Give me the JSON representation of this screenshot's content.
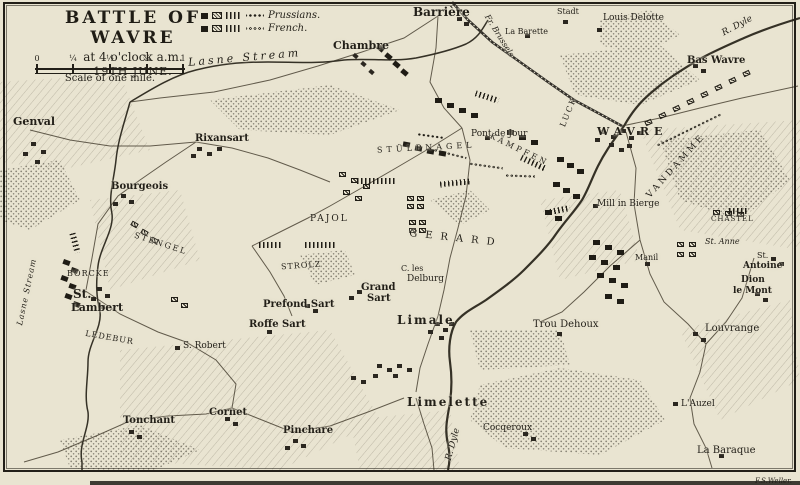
{
  "title_block": {
    "title": "BATTLE OF WAVRE",
    "subtitle": "at 4 o'clock a.m.",
    "date": "19TH JUNE.",
    "scale_caption": "Scale of one mile.",
    "scale_ticks": [
      "0",
      "¼",
      "½",
      "¾",
      "1"
    ]
  },
  "legend": {
    "prussians_label": "Prussians.",
    "french_label": "French."
  },
  "signature": "F.S.Weller.",
  "colors": {
    "paper": "#e9e4d1",
    "ink": "#221f18",
    "unit_black": "#1f1c15"
  },
  "labels": [
    {
      "t": "Lasne Stream",
      "x": 183,
      "y": 48,
      "fs": 11,
      "i": 1,
      "ls": 3,
      "r": -5
    },
    {
      "t": "Barrière",
      "x": 408,
      "y": 2,
      "fs": 12,
      "b": 1
    },
    {
      "t": "Chambre",
      "x": 328,
      "y": 36,
      "fs": 11,
      "b": 1
    },
    {
      "t": "La Barette",
      "x": 500,
      "y": 24,
      "fs": 8
    },
    {
      "t": "Stadt",
      "x": 552,
      "y": 4,
      "fs": 8
    },
    {
      "t": "Louis Delotte",
      "x": 598,
      "y": 10,
      "fs": 9
    },
    {
      "t": "R. Dyle",
      "x": 716,
      "y": 18,
      "fs": 9,
      "i": 1,
      "r": -28
    },
    {
      "t": "Bas Wavre",
      "x": 682,
      "y": 52,
      "fs": 10,
      "b": 1
    },
    {
      "t": "Fr. Brussels",
      "x": 470,
      "y": 28,
      "fs": 8,
      "i": 1,
      "r": 58
    },
    {
      "t": "Genval",
      "x": 8,
      "y": 112,
      "fs": 11,
      "b": 1
    },
    {
      "t": "Rixansart",
      "x": 190,
      "y": 130,
      "fs": 10,
      "b": 1
    },
    {
      "t": "Bourgeois",
      "x": 106,
      "y": 178,
      "fs": 10,
      "b": 1
    },
    {
      "t": "Pont de Jour",
      "x": 466,
      "y": 126,
      "fs": 9
    },
    {
      "t": "WAVRE",
      "x": 592,
      "y": 122,
      "fs": 11,
      "ls": 5,
      "b": 1
    },
    {
      "t": "LUCK",
      "x": 548,
      "y": 104,
      "fs": 8,
      "ls": 2,
      "r": -68
    },
    {
      "t": "STÜLPNAGEL",
      "x": 372,
      "y": 140,
      "fs": 8,
      "ls": 4,
      "r": -3
    },
    {
      "t": "KÄMPFEN",
      "x": 482,
      "y": 142,
      "fs": 8,
      "ls": 3,
      "r": 26
    },
    {
      "t": "VANDAMME",
      "x": 630,
      "y": 158,
      "fs": 9,
      "ls": 3,
      "r": -48
    },
    {
      "t": "Mill in Bierge",
      "x": 592,
      "y": 196,
      "fs": 9
    },
    {
      "t": "PAJOL",
      "x": 305,
      "y": 211,
      "fs": 9,
      "ls": 2
    },
    {
      "t": "GERARD",
      "x": 404,
      "y": 230,
      "fs": 10,
      "ls": 8,
      "r": 6
    },
    {
      "t": "STENGEL",
      "x": 128,
      "y": 236,
      "fs": 8,
      "ls": 2,
      "r": 18
    },
    {
      "t": "BORCKE",
      "x": 62,
      "y": 266,
      "fs": 8,
      "ls": 1
    },
    {
      "t": "St.",
      "x": 68,
      "y": 284,
      "fs": 12,
      "b": 1
    },
    {
      "t": "Lambert",
      "x": 66,
      "y": 298,
      "fs": 11,
      "b": 1
    },
    {
      "t": "LEDEBUR",
      "x": 80,
      "y": 330,
      "fs": 8,
      "ls": 1,
      "r": 10
    },
    {
      "t": "Lasne Stream",
      "x": -12,
      "y": 284,
      "fs": 8,
      "i": 1,
      "r": -78,
      "ls": 1
    },
    {
      "t": "STROLZ",
      "x": 276,
      "y": 258,
      "fs": 8,
      "ls": 1,
      "r": -4
    },
    {
      "t": "Prefond Sart",
      "x": 258,
      "y": 296,
      "fs": 10,
      "b": 1
    },
    {
      "t": "Grand",
      "x": 356,
      "y": 279,
      "fs": 10,
      "b": 1
    },
    {
      "t": "Sart",
      "x": 362,
      "y": 290,
      "fs": 10,
      "b": 1
    },
    {
      "t": "Roffe Sart",
      "x": 244,
      "y": 316,
      "fs": 10,
      "b": 1
    },
    {
      "t": "C. les",
      "x": 396,
      "y": 261,
      "fs": 8
    },
    {
      "t": "Delburg",
      "x": 402,
      "y": 271,
      "fs": 9
    },
    {
      "t": "Limale",
      "x": 392,
      "y": 310,
      "fs": 12,
      "b": 1,
      "ls": 2
    },
    {
      "t": "S. Robert",
      "x": 178,
      "y": 338,
      "fs": 9
    },
    {
      "t": "Trou Dehoux",
      "x": 528,
      "y": 316,
      "fs": 10
    },
    {
      "t": "Manil",
      "x": 630,
      "y": 250,
      "fs": 8
    },
    {
      "t": "Louvrange",
      "x": 700,
      "y": 320,
      "fs": 10
    },
    {
      "t": "Dion",
      "x": 736,
      "y": 272,
      "fs": 9,
      "b": 1
    },
    {
      "t": "le Mont",
      "x": 728,
      "y": 283,
      "fs": 9,
      "b": 1
    },
    {
      "t": "St.",
      "x": 752,
      "y": 248,
      "fs": 8
    },
    {
      "t": "Antoine",
      "x": 738,
      "y": 258,
      "fs": 9,
      "b": 1
    },
    {
      "t": "St. Anne",
      "x": 700,
      "y": 234,
      "fs": 8,
      "i": 1
    },
    {
      "t": "CHASTEL",
      "x": 706,
      "y": 212,
      "fs": 7,
      "ls": 1
    },
    {
      "t": "Tonchant",
      "x": 118,
      "y": 412,
      "fs": 10,
      "b": 1
    },
    {
      "t": "Cornet",
      "x": 204,
      "y": 404,
      "fs": 10,
      "b": 1
    },
    {
      "t": "Pinchare",
      "x": 278,
      "y": 422,
      "fs": 10,
      "b": 1
    },
    {
      "t": "Limelette",
      "x": 402,
      "y": 392,
      "fs": 12,
      "b": 1,
      "ls": 2
    },
    {
      "t": "R. Dyle",
      "x": 432,
      "y": 436,
      "fs": 9,
      "i": 1,
      "r": -75
    },
    {
      "t": "Cocqeroux",
      "x": 478,
      "y": 420,
      "fs": 9
    },
    {
      "t": "L'Auzel",
      "x": 676,
      "y": 396,
      "fs": 9
    },
    {
      "t": "La Baraque",
      "x": 692,
      "y": 442,
      "fs": 10
    }
  ],
  "units": [
    {
      "k": "p",
      "x": 372,
      "y": 42,
      "r": 40
    },
    {
      "k": "p",
      "x": 380,
      "y": 50,
      "r": 40
    },
    {
      "k": "p",
      "x": 388,
      "y": 58,
      "r": 40
    },
    {
      "k": "p",
      "x": 396,
      "y": 66,
      "r": 40
    },
    {
      "k": "p",
      "x": 430,
      "y": 94
    },
    {
      "k": "p",
      "x": 442,
      "y": 99
    },
    {
      "k": "p",
      "x": 454,
      "y": 104
    },
    {
      "k": "p",
      "x": 466,
      "y": 109
    },
    {
      "k": "p",
      "x": 502,
      "y": 126
    },
    {
      "k": "p",
      "x": 514,
      "y": 131
    },
    {
      "k": "p",
      "x": 526,
      "y": 136
    },
    {
      "k": "p",
      "x": 552,
      "y": 153
    },
    {
      "k": "p",
      "x": 562,
      "y": 159
    },
    {
      "k": "p",
      "x": 572,
      "y": 165
    },
    {
      "k": "p",
      "x": 548,
      "y": 178
    },
    {
      "k": "p",
      "x": 558,
      "y": 184
    },
    {
      "k": "p",
      "x": 568,
      "y": 190
    },
    {
      "k": "p",
      "x": 540,
      "y": 206
    },
    {
      "k": "p",
      "x": 550,
      "y": 212
    },
    {
      "k": "p",
      "x": 588,
      "y": 236
    },
    {
      "k": "p",
      "x": 600,
      "y": 241
    },
    {
      "k": "p",
      "x": 612,
      "y": 246
    },
    {
      "k": "p",
      "x": 584,
      "y": 251
    },
    {
      "k": "p",
      "x": 596,
      "y": 256
    },
    {
      "k": "p",
      "x": 608,
      "y": 261
    },
    {
      "k": "p",
      "x": 592,
      "y": 269
    },
    {
      "k": "p",
      "x": 604,
      "y": 274
    },
    {
      "k": "p",
      "x": 616,
      "y": 279
    },
    {
      "k": "p",
      "x": 600,
      "y": 290
    },
    {
      "k": "p",
      "x": 612,
      "y": 295
    },
    {
      "k": "p",
      "x": 58,
      "y": 256,
      "r": 20
    },
    {
      "k": "p",
      "x": 66,
      "y": 264,
      "r": 20
    },
    {
      "k": "p",
      "x": 56,
      "y": 272,
      "r": 20
    },
    {
      "k": "p",
      "x": 64,
      "y": 280,
      "r": 20
    },
    {
      "k": "p",
      "x": 60,
      "y": 290,
      "r": 20
    },
    {
      "k": "p",
      "x": 68,
      "y": 298,
      "r": 20
    },
    {
      "k": "p",
      "x": 398,
      "y": 138,
      "r": 10
    },
    {
      "k": "p",
      "x": 410,
      "y": 142,
      "r": 10
    },
    {
      "k": "p",
      "x": 422,
      "y": 145,
      "r": 10
    },
    {
      "k": "p",
      "x": 434,
      "y": 147,
      "r": 10
    },
    {
      "k": "f",
      "x": 126,
      "y": 218,
      "r": 30
    },
    {
      "k": "f",
      "x": 136,
      "y": 226,
      "r": 30
    },
    {
      "k": "f",
      "x": 146,
      "y": 234,
      "r": 30
    },
    {
      "k": "f",
      "x": 166,
      "y": 293
    },
    {
      "k": "f",
      "x": 176,
      "y": 299
    },
    {
      "k": "f",
      "x": 334,
      "y": 168
    },
    {
      "k": "f",
      "x": 346,
      "y": 174
    },
    {
      "k": "f",
      "x": 358,
      "y": 180
    },
    {
      "k": "f",
      "x": 338,
      "y": 186
    },
    {
      "k": "f",
      "x": 350,
      "y": 192
    },
    {
      "k": "f",
      "x": 402,
      "y": 192
    },
    {
      "k": "f",
      "x": 412,
      "y": 192
    },
    {
      "k": "f",
      "x": 402,
      "y": 200
    },
    {
      "k": "f",
      "x": 412,
      "y": 200
    },
    {
      "k": "f",
      "x": 404,
      "y": 216
    },
    {
      "k": "f",
      "x": 414,
      "y": 216
    },
    {
      "k": "f",
      "x": 404,
      "y": 224
    },
    {
      "k": "f",
      "x": 414,
      "y": 224
    },
    {
      "k": "f",
      "x": 640,
      "y": 116,
      "r": -25
    },
    {
      "k": "f",
      "x": 654,
      "y": 109,
      "r": -25
    },
    {
      "k": "f",
      "x": 668,
      "y": 102,
      "r": -25
    },
    {
      "k": "f",
      "x": 682,
      "y": 95,
      "r": -25
    },
    {
      "k": "f",
      "x": 696,
      "y": 88,
      "r": -25
    },
    {
      "k": "f",
      "x": 710,
      "y": 81,
      "r": -25
    },
    {
      "k": "f",
      "x": 724,
      "y": 74,
      "r": -25
    },
    {
      "k": "f",
      "x": 738,
      "y": 67,
      "r": -25
    },
    {
      "k": "f",
      "x": 708,
      "y": 206
    },
    {
      "k": "f",
      "x": 720,
      "y": 207
    },
    {
      "k": "f",
      "x": 732,
      "y": 208
    },
    {
      "k": "f",
      "x": 672,
      "y": 238
    },
    {
      "k": "f",
      "x": 684,
      "y": 238
    },
    {
      "k": "f",
      "x": 672,
      "y": 248
    },
    {
      "k": "f",
      "x": 684,
      "y": 248
    },
    {
      "k": "t",
      "x": 352,
      "y": 174,
      "w": 38
    },
    {
      "k": "t",
      "x": 300,
      "y": 238,
      "w": 30
    },
    {
      "k": "t",
      "x": 254,
      "y": 238,
      "w": 24
    },
    {
      "k": "t",
      "x": 435,
      "y": 176,
      "w": 30,
      "r": -6
    },
    {
      "k": "t",
      "x": 515,
      "y": 156,
      "w": 26,
      "r": 25
    },
    {
      "k": "t",
      "x": 724,
      "y": 204,
      "w": 18
    },
    {
      "k": "t",
      "x": 470,
      "y": 90,
      "w": 24,
      "r": 18
    },
    {
      "k": "t",
      "x": 545,
      "y": 203,
      "w": 20,
      "r": -12
    },
    {
      "k": "t",
      "x": 60,
      "y": 236,
      "w": 20,
      "r": 75
    },
    {
      "k": "o",
      "x": 428,
      "y": 148,
      "w": 34,
      "r": 14
    },
    {
      "k": "o",
      "x": 464,
      "y": 160,
      "w": 34,
      "r": 8
    },
    {
      "k": "o",
      "x": 500,
      "y": 170,
      "w": 30,
      "r": 2
    },
    {
      "k": "o",
      "x": 648,
      "y": 124,
      "w": 72,
      "r": -26
    },
    {
      "k": "d",
      "x": 412,
      "y": 130,
      "w": 26,
      "r": 8
    }
  ],
  "towns": [
    {
      "x": 596,
      "y": 126
    },
    {
      "x": 606,
      "y": 131
    },
    {
      "x": 616,
      "y": 125
    },
    {
      "x": 624,
      "y": 132
    },
    {
      "x": 632,
      "y": 127
    },
    {
      "x": 604,
      "y": 139
    },
    {
      "x": 614,
      "y": 144
    },
    {
      "x": 590,
      "y": 134
    },
    {
      "x": 622,
      "y": 140
    },
    {
      "x": 688,
      "y": 60
    },
    {
      "x": 696,
      "y": 65
    },
    {
      "x": 348,
      "y": 50,
      "r": 40
    },
    {
      "x": 356,
      "y": 58,
      "r": 40
    },
    {
      "x": 364,
      "y": 66,
      "r": 40
    },
    {
      "x": 26,
      "y": 138
    },
    {
      "x": 36,
      "y": 146
    },
    {
      "x": 18,
      "y": 148
    },
    {
      "x": 30,
      "y": 156
    },
    {
      "x": 192,
      "y": 143
    },
    {
      "x": 202,
      "y": 148
    },
    {
      "x": 212,
      "y": 143
    },
    {
      "x": 186,
      "y": 150
    },
    {
      "x": 116,
      "y": 190
    },
    {
      "x": 124,
      "y": 196
    },
    {
      "x": 108,
      "y": 198
    },
    {
      "x": 92,
      "y": 283
    },
    {
      "x": 100,
      "y": 290
    },
    {
      "x": 86,
      "y": 293
    },
    {
      "x": 95,
      "y": 301
    },
    {
      "x": 430,
      "y": 318
    },
    {
      "x": 438,
      "y": 324
    },
    {
      "x": 423,
      "y": 326
    },
    {
      "x": 434,
      "y": 332
    },
    {
      "x": 444,
      "y": 318
    },
    {
      "x": 372,
      "y": 360
    },
    {
      "x": 382,
      "y": 364
    },
    {
      "x": 392,
      "y": 360
    },
    {
      "x": 402,
      "y": 364
    },
    {
      "x": 388,
      "y": 370
    },
    {
      "x": 368,
      "y": 370
    },
    {
      "x": 356,
      "y": 376
    },
    {
      "x": 346,
      "y": 372
    },
    {
      "x": 688,
      "y": 328
    },
    {
      "x": 696,
      "y": 334
    },
    {
      "x": 750,
      "y": 288
    },
    {
      "x": 758,
      "y": 294
    },
    {
      "x": 714,
      "y": 450
    },
    {
      "x": 124,
      "y": 426
    },
    {
      "x": 132,
      "y": 431
    },
    {
      "x": 220,
      "y": 413
    },
    {
      "x": 228,
      "y": 418
    },
    {
      "x": 288,
      "y": 435
    },
    {
      "x": 296,
      "y": 440
    },
    {
      "x": 280,
      "y": 442
    },
    {
      "x": 518,
      "y": 428
    },
    {
      "x": 526,
      "y": 433
    },
    {
      "x": 766,
      "y": 253
    },
    {
      "x": 774,
      "y": 258
    },
    {
      "x": 592,
      "y": 24
    },
    {
      "x": 558,
      "y": 16
    },
    {
      "x": 452,
      "y": 13
    },
    {
      "x": 459,
      "y": 18
    },
    {
      "x": 520,
      "y": 30
    },
    {
      "x": 552,
      "y": 328
    },
    {
      "x": 170,
      "y": 342
    },
    {
      "x": 352,
      "y": 286
    },
    {
      "x": 344,
      "y": 292
    },
    {
      "x": 300,
      "y": 300
    },
    {
      "x": 308,
      "y": 305
    },
    {
      "x": 262,
      "y": 326
    },
    {
      "x": 588,
      "y": 200
    },
    {
      "x": 640,
      "y": 258
    },
    {
      "x": 668,
      "y": 398
    },
    {
      "x": 480,
      "y": 132
    }
  ]
}
